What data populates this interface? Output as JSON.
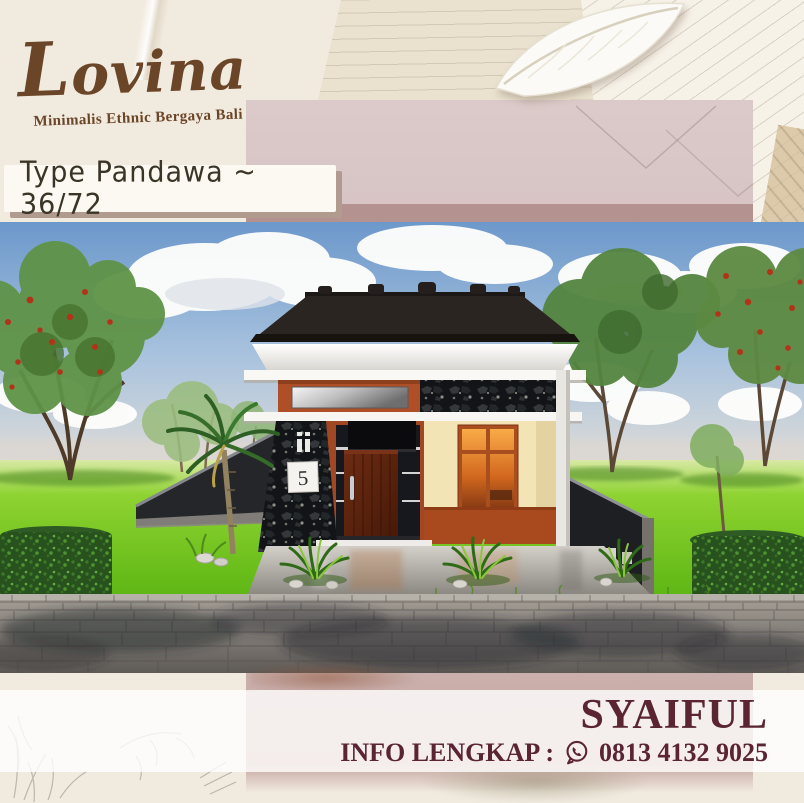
{
  "brand": {
    "name": "Lovina",
    "tagline": "Minimalis Ethnic Bergaya Bali",
    "color": "#6B4527"
  },
  "type_banner": {
    "label": "Type Pandawa ~ 36/72",
    "text_color": "#3A3526",
    "background": "#FCF9F2"
  },
  "house_render": {
    "house_number": "5"
  },
  "contact": {
    "agent_name": "SYAIFUL",
    "info_label": "INFO LENGKAP :",
    "phone": "0813 4132 9025",
    "icon": "whatsapp-icon",
    "text_color": "#5A2430"
  },
  "palette": {
    "cream_background": "#F1EADF",
    "envelope_pink": "#D6C2C2",
    "envelope_strip": "#B49290",
    "banner_shadow": "#B19B8E"
  }
}
